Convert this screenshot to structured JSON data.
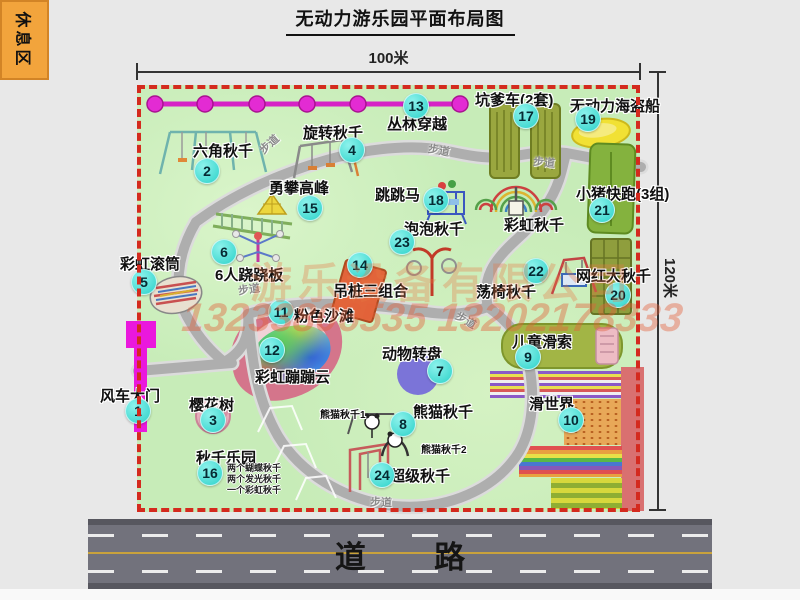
{
  "title": "无动力游乐园平面布局图",
  "dims": {
    "top_label": "100米",
    "right_label": "120米"
  },
  "road": {
    "label": "道路"
  },
  "watermark": {
    "company": "游乐设备有限公司",
    "phones": "13233806535 13202178333"
  },
  "rest_area": {
    "label": "休息区"
  },
  "path_label": "步道",
  "colors": {
    "park_green": "#c7ecb8",
    "border_red": "#d42a1e",
    "badge_cyan": "#2cd2c9",
    "chain_magenta": "#e32bd3",
    "gate_magenta": "#ea18dd",
    "road_gray": "#72727c",
    "rest_orange": "#f2a43c",
    "watermark_orange": "#e07a4a"
  },
  "items": [
    {
      "num": 1,
      "label": "风车大门",
      "lx": 100,
      "ly": 385,
      "bx": 138,
      "by": 411
    },
    {
      "num": 2,
      "label": "六角秋千",
      "lx": 193,
      "ly": 140,
      "bx": 207,
      "by": 171
    },
    {
      "num": 3,
      "label": "樱花树",
      "lx": 189,
      "ly": 394,
      "bx": 213,
      "by": 420
    },
    {
      "num": 4,
      "label": "旋转秋千",
      "lx": 303,
      "ly": 122,
      "bx": 352,
      "by": 150
    },
    {
      "num": 5,
      "label": "彩虹滚筒",
      "lx": 120,
      "ly": 253,
      "bx": 144,
      "by": 282
    },
    {
      "num": 6,
      "label": "6人跷跷板",
      "lx": 215,
      "ly": 264,
      "bx": 224,
      "by": 252
    },
    {
      "num": 7,
      "label": "动物转盘",
      "lx": 382,
      "ly": 343,
      "bx": 440,
      "by": 371
    },
    {
      "num": 8,
      "label": "熊猫秋千",
      "lx": 413,
      "ly": 401,
      "bx": 403,
      "by": 424
    },
    {
      "num": 9,
      "label": "儿童滑索",
      "lx": 512,
      "ly": 331,
      "bx": 528,
      "by": 357
    },
    {
      "num": 10,
      "label": "滑世界",
      "lx": 529,
      "ly": 393,
      "bx": 571,
      "by": 420
    },
    {
      "num": 11,
      "label": "粉色沙滩",
      "lx": 294,
      "ly": 305,
      "bx": 281,
      "by": 312
    },
    {
      "num": 12,
      "label": "彩虹蹦蹦云",
      "lx": 255,
      "ly": 366,
      "bx": 272,
      "by": 350
    },
    {
      "num": 13,
      "label": "丛林穿越",
      "lx": 387,
      "ly": 113,
      "bx": 416,
      "by": 106
    },
    {
      "num": 14,
      "label": "吊桩三组合",
      "lx": 333,
      "ly": 280,
      "bx": 360,
      "by": 265
    },
    {
      "num": 15,
      "label": "勇攀高峰",
      "lx": 269,
      "ly": 177,
      "bx": 310,
      "by": 208
    },
    {
      "num": 16,
      "label": "秋千乐园",
      "lx": 196,
      "ly": 447,
      "bx": 210,
      "by": 473,
      "sub": [
        "两个蝴蝶秋千",
        "两个发光秋千",
        "一个彩虹秋千"
      ],
      "sx": 227,
      "sy": 463
    },
    {
      "num": 17,
      "label": "坑爹车(2套)",
      "lx": 475,
      "ly": 89,
      "bx": 526,
      "by": 116
    },
    {
      "num": 18,
      "label": "跳跳马",
      "lx": 375,
      "ly": 184,
      "bx": 436,
      "by": 200
    },
    {
      "num": 19,
      "label": "无动力海盗船",
      "lx": 570,
      "ly": 95,
      "bx": 588,
      "by": 119
    },
    {
      "num": 20,
      "label": "网红大秋千",
      "lx": 576,
      "ly": 265,
      "bx": 618,
      "by": 295
    },
    {
      "num": 21,
      "label": "小猪快跑(3组)",
      "lx": 576,
      "ly": 183,
      "bx": 602,
      "by": 210
    },
    {
      "num": 22,
      "label": "荡椅秋千",
      "lx": 476,
      "ly": 281,
      "bx": 536,
      "by": 271
    },
    {
      "num": 23,
      "label": "泡泡秋千",
      "lx": 404,
      "ly": 218,
      "bx": 402,
      "by": 242
    },
    {
      "num": 24,
      "label": "超级秋千",
      "lx": 390,
      "ly": 465,
      "bx": 382,
      "by": 475
    }
  ],
  "small_labels": [
    {
      "text": "彩虹秋千",
      "x": 504,
      "y": 214,
      "fs": 15
    },
    {
      "text": "熊猫秋千1",
      "x": 320,
      "y": 406,
      "fs": 10
    },
    {
      "text": "熊猫秋千2",
      "x": 421,
      "y": 441,
      "fs": 10
    }
  ],
  "path_markers": [
    {
      "x": 258,
      "y": 136,
      "r": -42
    },
    {
      "x": 428,
      "y": 142,
      "r": 10
    },
    {
      "x": 533,
      "y": 154,
      "r": 6
    },
    {
      "x": 238,
      "y": 281,
      "r": -8
    },
    {
      "x": 455,
      "y": 312,
      "r": 30
    },
    {
      "x": 370,
      "y": 494,
      "r": 2
    }
  ]
}
